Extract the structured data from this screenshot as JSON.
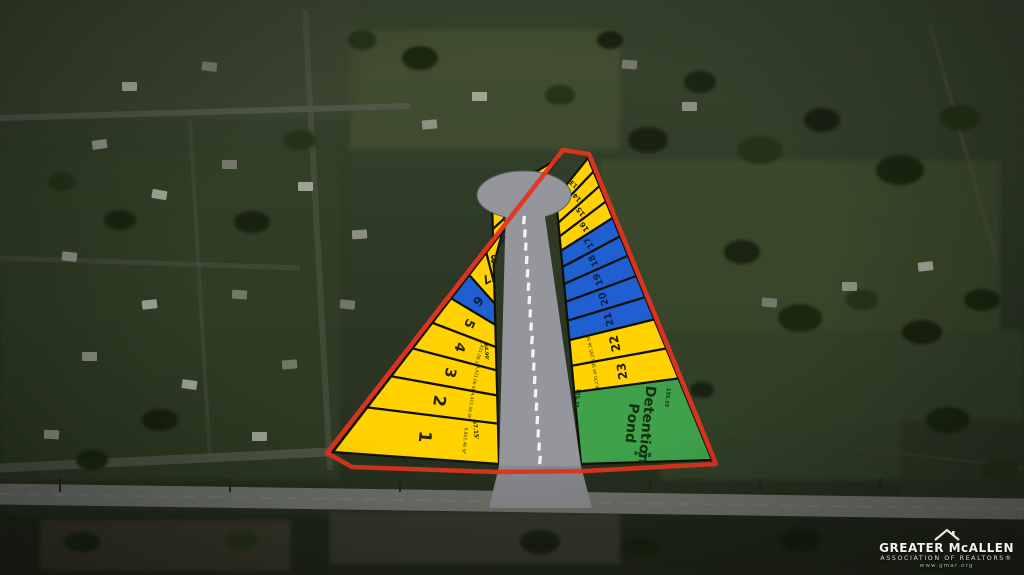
{
  "plat": {
    "outline_color": "#e23420",
    "road_color": "#94969b",
    "road_dash_color": "#f2f2ee",
    "colors": {
      "yellow": "#ffd200",
      "blue": "#1f5fd0",
      "green": "#3fa24b",
      "divider": "#101008"
    },
    "pond_lines": [
      "Detention",
      "Pond"
    ],
    "left_lots_top_to_bottom": [
      {
        "number": "12",
        "color": "yellow",
        "area": null
      },
      {
        "number": "11",
        "color": "yellow",
        "area": null
      },
      {
        "number": "10",
        "color": "yellow",
        "area": null
      },
      {
        "number": "9",
        "color": "blue",
        "area": null
      },
      {
        "number": "8",
        "color": "yellow",
        "area": null
      },
      {
        "number": "7",
        "color": "yellow",
        "area": null
      },
      {
        "number": "6",
        "color": "blue",
        "area": null
      },
      {
        "number": "5",
        "color": "yellow",
        "area": null
      },
      {
        "number": "4",
        "color": "yellow",
        "area": "4,421.06 SF"
      },
      {
        "number": "3",
        "color": "yellow",
        "area": "4,421.06 SF"
      },
      {
        "number": "2",
        "color": "yellow",
        "area": "4,421.06 SF"
      },
      {
        "number": "1",
        "color": "yellow",
        "area": "6,812.46 SF"
      }
    ],
    "right_lots_top_to_bottom": [
      {
        "number": "13",
        "color": "yellow",
        "area": null
      },
      {
        "number": "14",
        "color": "yellow",
        "area": null
      },
      {
        "number": "15",
        "color": "yellow",
        "area": null
      },
      {
        "number": "16",
        "color": "yellow",
        "area": null
      },
      {
        "number": "17",
        "color": "blue",
        "area": null
      },
      {
        "number": "18",
        "color": "blue",
        "area": null
      },
      {
        "number": "19",
        "color": "blue",
        "area": null
      },
      {
        "number": "20",
        "color": "blue",
        "area": null
      },
      {
        "number": "21",
        "color": "blue",
        "area": null
      },
      {
        "number": "22",
        "color": "yellow",
        "area": "6,285.36 SF"
      },
      {
        "number": "23",
        "color": "yellow",
        "area": "6,230.44 SF"
      }
    ],
    "dimensions": [
      {
        "text": "57.15'"
      },
      {
        "text": "94.99'"
      },
      {
        "text": "64.90'"
      },
      {
        "text": "86.94"
      },
      {
        "text": "135.35"
      },
      {
        "text": "135.35'"
      }
    ]
  },
  "logo": {
    "name_line": "GREATER McALLEN",
    "sub_line": "ASSOCIATION OF REALTORS®",
    "url_line": "www.gmar.org"
  }
}
